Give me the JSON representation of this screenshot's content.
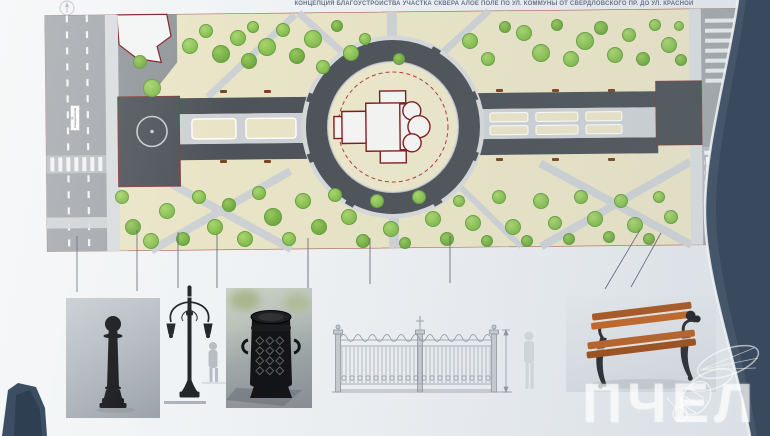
{
  "title": "КОНЦЕПЦИЯ БЛАГОУСТРОЙСТВА УЧАСТКА СКВЕРА  АЛОЕ ПОЛЕ  ПО УЛ. КОММУНЫ ОТ СВЕРДЛОВСКОГО ПР. ДО УЛ. КРАСНОЙ",
  "watermark": {
    "text": "ПЧЕЛ"
  },
  "plan": {
    "street_labels": {
      "left": "пр. Свердловский",
      "right": "ул. Красная"
    },
    "colors": {
      "paper": "#eef1f3",
      "lawn": "#e9e4c6",
      "paving_dark": "#4d5358",
      "path_light": "#cdd1d4",
      "road": "#a3a7ab",
      "tree": "#8fc355",
      "church_outline": "#7d1b1b",
      "fence_red_dashed": "#b23a3a",
      "frame_dark": "#42526a",
      "bench_wood": "#b5581d"
    },
    "trees": [
      [
        152,
        88,
        9
      ],
      [
        140,
        62,
        7
      ],
      [
        190,
        46,
        8
      ],
      [
        206,
        31,
        7
      ],
      [
        221,
        54,
        9
      ],
      [
        238,
        38,
        8
      ],
      [
        253,
        27,
        6
      ],
      [
        249,
        61,
        8
      ],
      [
        267,
        47,
        9
      ],
      [
        283,
        30,
        7
      ],
      [
        297,
        56,
        8
      ],
      [
        313,
        39,
        9
      ],
      [
        323,
        67,
        7
      ],
      [
        337,
        26,
        6
      ],
      [
        351,
        53,
        8
      ],
      [
        365,
        39,
        6
      ],
      [
        399,
        59,
        6
      ],
      [
        470,
        41,
        8
      ],
      [
        488,
        59,
        7
      ],
      [
        505,
        27,
        6
      ],
      [
        524,
        33,
        8
      ],
      [
        541,
        53,
        9
      ],
      [
        557,
        25,
        6
      ],
      [
        571,
        59,
        8
      ],
      [
        585,
        41,
        9
      ],
      [
        601,
        28,
        7
      ],
      [
        615,
        55,
        8
      ],
      [
        629,
        35,
        7
      ],
      [
        643,
        59,
        7
      ],
      [
        655,
        25,
        6
      ],
      [
        669,
        45,
        8
      ],
      [
        681,
        60,
        6
      ],
      [
        679,
        26,
        5
      ],
      [
        122,
        197,
        7
      ],
      [
        133,
        227,
        8
      ],
      [
        151,
        241,
        8
      ],
      [
        167,
        211,
        8
      ],
      [
        183,
        239,
        7
      ],
      [
        199,
        197,
        7
      ],
      [
        215,
        227,
        8
      ],
      [
        229,
        205,
        7
      ],
      [
        245,
        239,
        8
      ],
      [
        259,
        193,
        7
      ],
      [
        273,
        217,
        9
      ],
      [
        289,
        239,
        7
      ],
      [
        303,
        201,
        8
      ],
      [
        319,
        227,
        8
      ],
      [
        335,
        195,
        7
      ],
      [
        349,
        217,
        8
      ],
      [
        363,
        241,
        7
      ],
      [
        377,
        201,
        7
      ],
      [
        391,
        229,
        8
      ],
      [
        405,
        243,
        6
      ],
      [
        419,
        197,
        7
      ],
      [
        433,
        219,
        8
      ],
      [
        447,
        239,
        7
      ],
      [
        459,
        201,
        6
      ],
      [
        473,
        223,
        8
      ],
      [
        487,
        241,
        6
      ],
      [
        499,
        197,
        7
      ],
      [
        513,
        227,
        8
      ],
      [
        527,
        241,
        6
      ],
      [
        541,
        201,
        8
      ],
      [
        555,
        223,
        7
      ],
      [
        569,
        239,
        6
      ],
      [
        581,
        197,
        7
      ],
      [
        595,
        219,
        8
      ],
      [
        609,
        237,
        6
      ],
      [
        621,
        201,
        7
      ],
      [
        635,
        225,
        8
      ],
      [
        649,
        239,
        6
      ],
      [
        659,
        197,
        6
      ],
      [
        671,
        217,
        7
      ]
    ],
    "benches": [
      [
        220,
        90
      ],
      [
        264,
        90
      ],
      [
        496,
        89
      ],
      [
        552,
        89
      ],
      [
        608,
        89
      ],
      [
        496,
        158
      ],
      [
        552,
        158
      ],
      [
        608,
        158
      ],
      [
        220,
        160
      ],
      [
        264,
        160
      ]
    ],
    "leader_lines": [
      [
        77,
        236,
        77,
        292
      ],
      [
        137,
        230,
        137,
        291
      ],
      [
        178,
        232,
        178,
        288
      ],
      [
        217,
        234,
        217,
        288
      ],
      [
        308,
        238,
        308,
        289
      ],
      [
        370,
        238,
        370,
        284
      ],
      [
        450,
        236,
        450,
        283
      ],
      [
        640,
        230,
        605,
        289
      ],
      [
        661,
        233,
        631,
        287
      ]
    ]
  },
  "furniture": {
    "items": [
      {
        "name": "bollard"
      },
      {
        "name": "street-lamp"
      },
      {
        "name": "litter-urn"
      },
      {
        "name": "ornamental-fence"
      },
      {
        "name": "bench"
      }
    ]
  }
}
